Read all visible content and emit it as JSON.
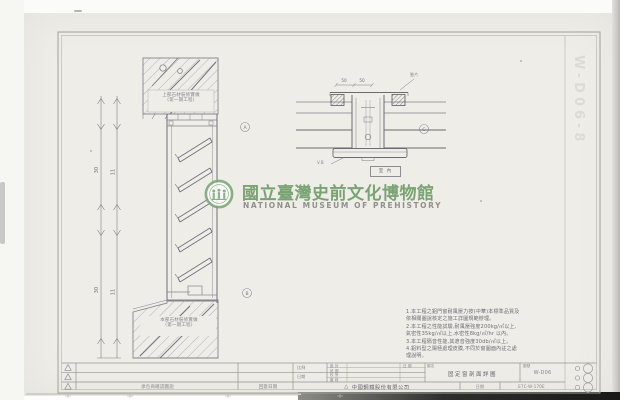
{
  "watermark": {
    "title_zh": "國立臺灣史前文化博物館",
    "title_en": "NATIONAL MUSEUM OF PREHISTORY"
  },
  "margin_code": "W-D06-8",
  "left_drawing": {
    "top_box_label1": "上部石材裝修實做",
    "top_box_label2": "(第一期工程)",
    "bottom_box_label1": "本部石材裝修實做",
    "bottom_box_label2": "(第一期工程)",
    "dim_outer_upper": "30",
    "dim_outer_lower": "30",
    "dim_inner_upper": "11",
    "dim_inner_lower": "11",
    "marker_top": "A",
    "marker_bottom": "B"
  },
  "right_drawing": {
    "dim_left": "50",
    "dim_right": "50",
    "label_top": "墊片",
    "label_bottom": "V.B",
    "box_label": "室 內",
    "marker": "C"
  },
  "notes": {
    "items": [
      "1.本工程之鋁門窗耐風壓力按(中華)本標準品質及",
      "  依相關圖說核定之施工詳圖規範辦理。",
      "2.本工程之性能試驗,耐風壓強度200kg/㎡以上,",
      "  氣密性35kg/㎡以上,水密性8kg/㎡/hr 以內。",
      "3.本工程隔音性能,其遮音強度30db/㎡以上。",
      "4.鋁料型之陽極處理皮膜,不同於窗圖面內註之處",
      "  理說明。"
    ]
  },
  "titleblock": {
    "desc_label": "承包商確認圖說",
    "date_label": "回簽日期",
    "approvals": [
      "設 計",
      "繪 圖",
      "校 對",
      "審 核"
    ],
    "approval_date": "日 期",
    "scale_label": "比例",
    "date2_label": "日期",
    "title_label": "圖名",
    "drawing_title": "固定窗剖面詳圖",
    "number_label": "圖號",
    "drawing_number": "W-D06",
    "company_mark": "△",
    "company": "中國鋼鐵股份有限公司",
    "date_small": "日期",
    "sub_number": "E7C-W-170E"
  }
}
